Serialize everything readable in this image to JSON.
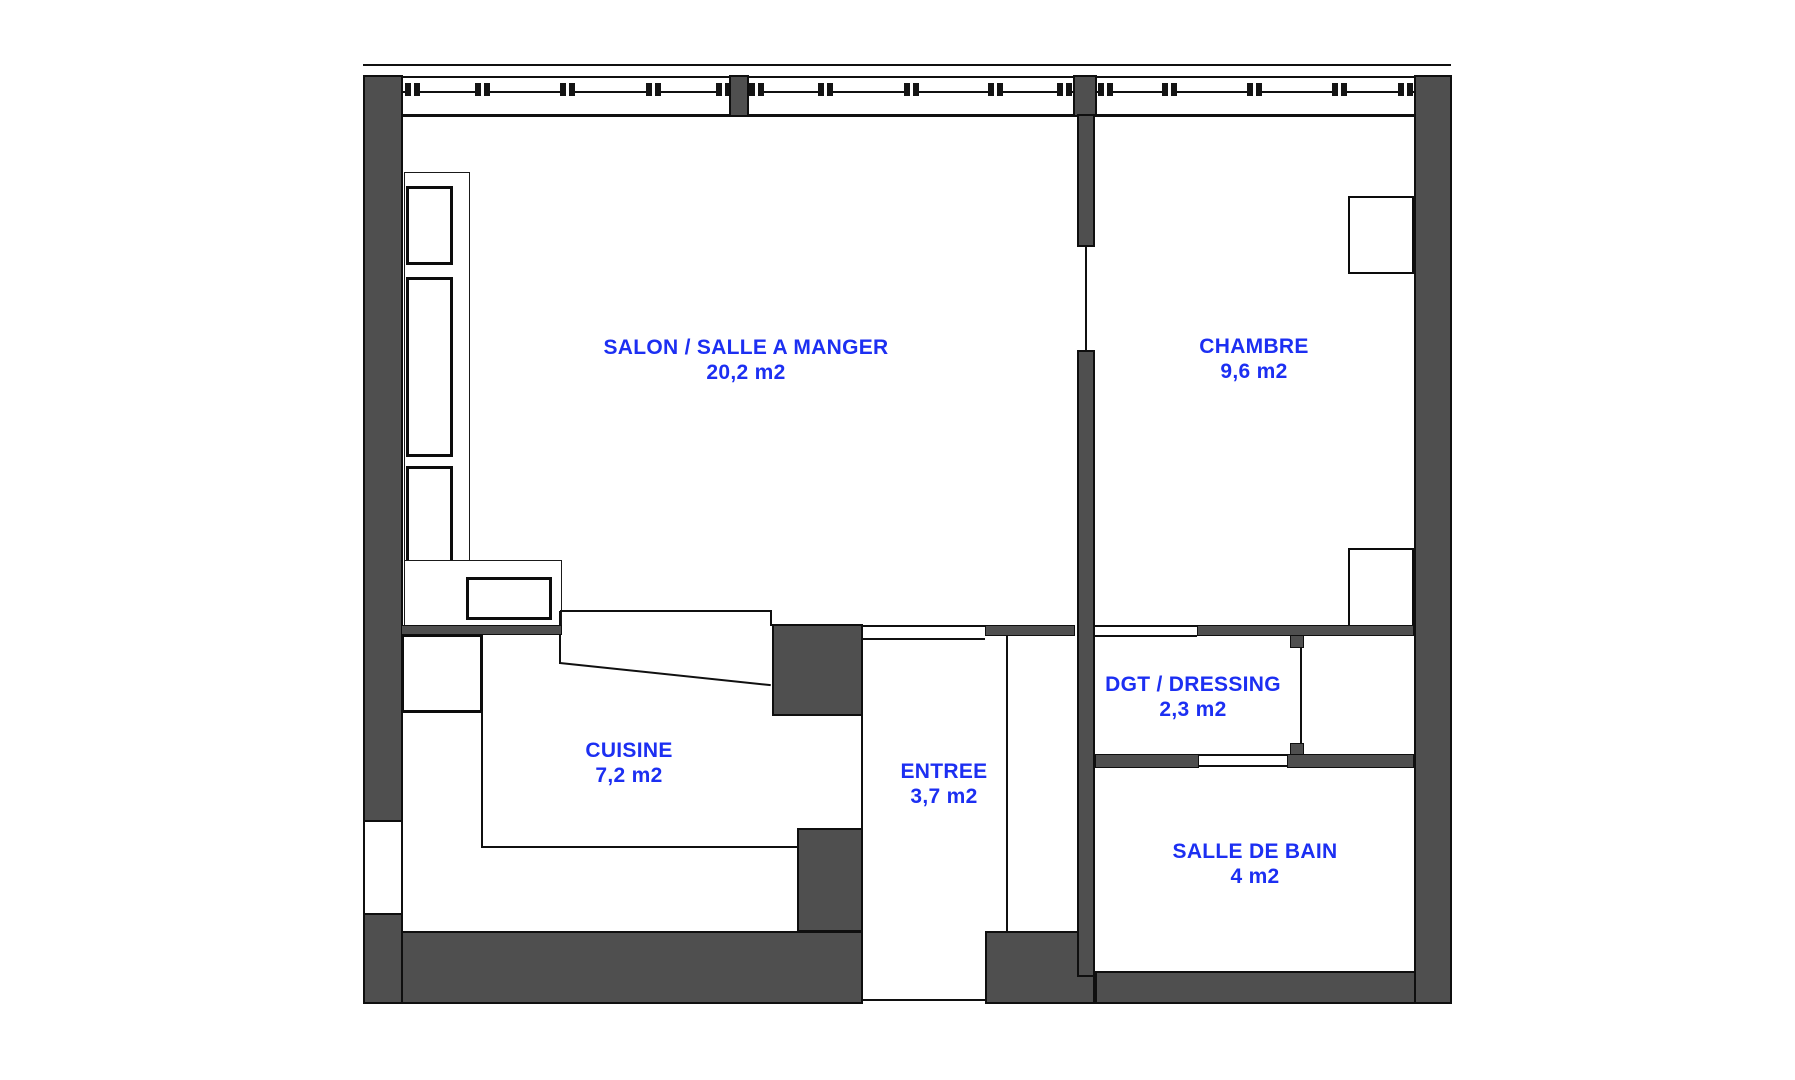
{
  "title": "Apartment floor plan",
  "colors": {
    "wall": "#4f4f4f",
    "line": "#101010",
    "label": "#1c2ff2",
    "background": "#ffffff"
  },
  "rooms": [
    {
      "id": "salon",
      "name": "SALON / SALLE A MANGER",
      "area": "20,2 m2"
    },
    {
      "id": "chambre",
      "name": "CHAMBRE",
      "area": "9,6 m2"
    },
    {
      "id": "cuisine",
      "name": "CUISINE",
      "area": "7,2 m2"
    },
    {
      "id": "entree",
      "name": "ENTREE",
      "area": "3,7 m2"
    },
    {
      "id": "dressing",
      "name": "DGT / DRESSING",
      "area": "2,3 m2"
    },
    {
      "id": "sdb",
      "name": "SALLE DE BAIN",
      "area": "4 m2"
    }
  ]
}
